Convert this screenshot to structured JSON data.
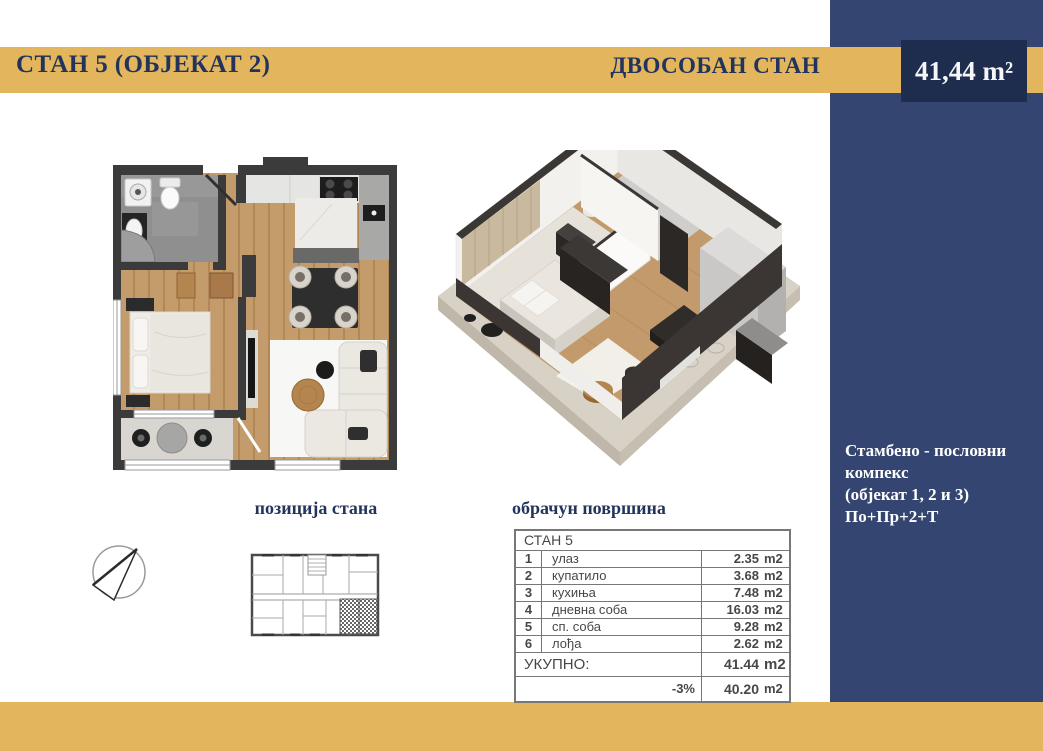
{
  "colors": {
    "gold": "#E3B55C",
    "blue_column": "#344571",
    "navy_box": "#1E2C4E",
    "heading_text": "#22345C",
    "table_text": "#474747"
  },
  "header": {
    "title": "СТАН 5 (ОБЈЕКАТ 2)",
    "subtitle": "ДВОСОБАН СТАН",
    "area": "41,44 m²"
  },
  "complex": {
    "lines": [
      "Стамбено - пословни",
      "компекс",
      "(објекат 1, 2 и 3)",
      "По+Пр+2+Т"
    ]
  },
  "sections": {
    "position_title": "позиција стана",
    "calc_title": "обрачун површина"
  },
  "table": {
    "title": "СТАН 5",
    "rows": [
      {
        "num": "1",
        "label": "улаз",
        "value": "2.35",
        "unit": "m2"
      },
      {
        "num": "2",
        "label": "купатило",
        "value": "3.68",
        "unit": "m2"
      },
      {
        "num": "3",
        "label": "кухиња",
        "value": "7.48",
        "unit": "m2"
      },
      {
        "num": "4",
        "label": "дневна соба",
        "value": "16.03",
        "unit": "m2"
      },
      {
        "num": "5",
        "label": "сп. соба",
        "value": "9.28",
        "unit": "m2"
      },
      {
        "num": "6",
        "label": "лођа",
        "value": "2.62",
        "unit": "m2"
      }
    ],
    "total": {
      "label": "УКУПНО:",
      "value": "41.44",
      "unit": "m2"
    },
    "reduced": {
      "label": "-3%",
      "value": "40.20",
      "unit": "m2"
    }
  }
}
